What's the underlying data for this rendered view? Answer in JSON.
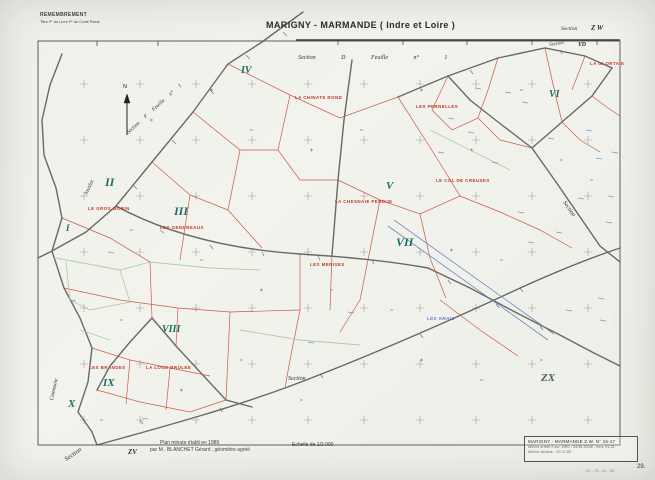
{
  "header": {
    "remembrement_line1": "REMEMBREMENT",
    "remembrement_line2": "Titre Iᵉʳ du Livre Iᵉʳ du Code Rural",
    "title": "MARIGNY - MARMANDE   ( Indre et Loire )",
    "section_label": "Section",
    "section_value": "Z W"
  },
  "map": {
    "north_label": "N",
    "section_texts": {
      "top": "Section    D    Feuille    n° 1",
      "diagonal": "Section   F   Feuille   n° 1",
      "top_right_label": "Section",
      "right_label": "Section",
      "bottom_label": "Section",
      "bottom_left_label": "Section",
      "commune": "Commune",
      "stream": "Jauslot"
    },
    "adjacent_sheets": {
      "yd": "YD",
      "zv": "ZV",
      "zx": "ZX"
    },
    "romans": [
      "I",
      "II",
      "III",
      "IV",
      "V",
      "VI",
      "VII",
      "VIII",
      "IX",
      "X"
    ],
    "red_labels": [
      {
        "text": "LA CHINATE ROND"
      },
      {
        "text": "LES PERNELLES"
      },
      {
        "text": "LA GLORTAIE"
      },
      {
        "text": "LE GROS MORIN"
      },
      {
        "text": "LES GENDREAUX"
      },
      {
        "text": "LA CHESNAIE PERDUE"
      },
      {
        "text": "LE COL DE CREUSES"
      },
      {
        "text": "LES MERISES"
      },
      {
        "text": "LES BRANDES"
      },
      {
        "text": "LA LOGE BRÛLÉE"
      }
    ],
    "blue_label": "LES GRAIS"
  },
  "footer": {
    "plan_line1": "Plan minute établi en 1989",
    "plan_line2": "par M . BLANCHET Gérard , géomètre  agréé",
    "scale": "Echelle de   1/2 000",
    "page_number": "29.",
    "refs": "01 - 73 - 61 - 50"
  },
  "cartouche": {
    "line1": "MARIGNY - MARMANDE    Z.W.  N° 15-17",
    "line2": "Affiché arrêté 2 avr. 1990 - 34/48-30/48 - renv. 01-01",
    "line3": "Affiché attribué - 20-07-89"
  },
  "colors": {
    "paper": "#f1f2ec",
    "road": "#565656",
    "parcel_red": "#c8493a",
    "parcel_green": "#a5cba2",
    "drain_blue": "#5b7fc4",
    "roman_teal": "#1d6e5e"
  }
}
